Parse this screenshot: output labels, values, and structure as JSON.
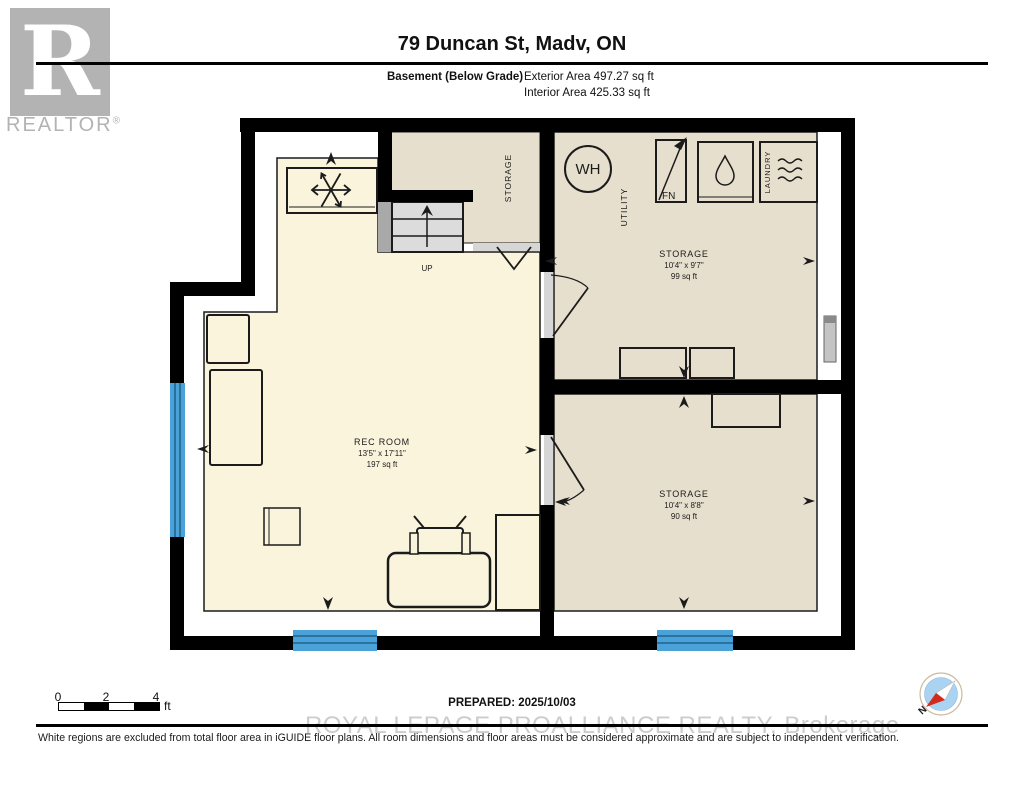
{
  "header": {
    "title": "79 Duncan St, Madv, ON",
    "floor_label": "Basement (Below Grade)",
    "exterior_area": "Exterior Area 497.27 sq ft",
    "interior_area": "Interior Area 425.33 sq ft"
  },
  "logo": {
    "letter": "R",
    "text": "REALTOR",
    "registered": "®"
  },
  "plan": {
    "rec_room": {
      "name": "REC ROOM",
      "dims": "13'5\" x 17'11\"",
      "area": "197 sq ft"
    },
    "storage_upper": {
      "name": "STORAGE",
      "dims": "10'4\" x 9'7\"",
      "area": "99 sq ft"
    },
    "storage_lower": {
      "name": "STORAGE",
      "dims": "10'4\" x 8'8\"",
      "area": "90 sq ft"
    },
    "storage_closet_label": "STORAGE",
    "utility_label": "UTILITY",
    "laundry_label": "LAUNDRY",
    "water_heater_label": "WH",
    "furnace_label": "FN",
    "stairs_label": "UP"
  },
  "footer": {
    "scale": {
      "ticks": [
        "0",
        "2",
        "4"
      ],
      "unit": "ft"
    },
    "prepared": "PREPARED: 2025/10/03",
    "compass_north": "N",
    "watermark": "ROYAL LEPAGE PROALLIANCE REALTY, Brokerage",
    "disclaimer": "White regions are excluded from total floor area in iGUIDE floor plans. All room dimensions and floor areas must be considered approximate and are subject to independent verification."
  },
  "colors": {
    "wall": "#000000",
    "rec_room_fill": "#FBF4DD",
    "storage_fill": "#E7DFCD",
    "window_blue": "#4BA2D8",
    "stairs_gray": "#DCDCDC",
    "logo_gray": "#B3B3B3",
    "watermark_gray": "#CCCCCC",
    "compass_blue": "#A9D3F0",
    "compass_red": "#D42A1E"
  }
}
